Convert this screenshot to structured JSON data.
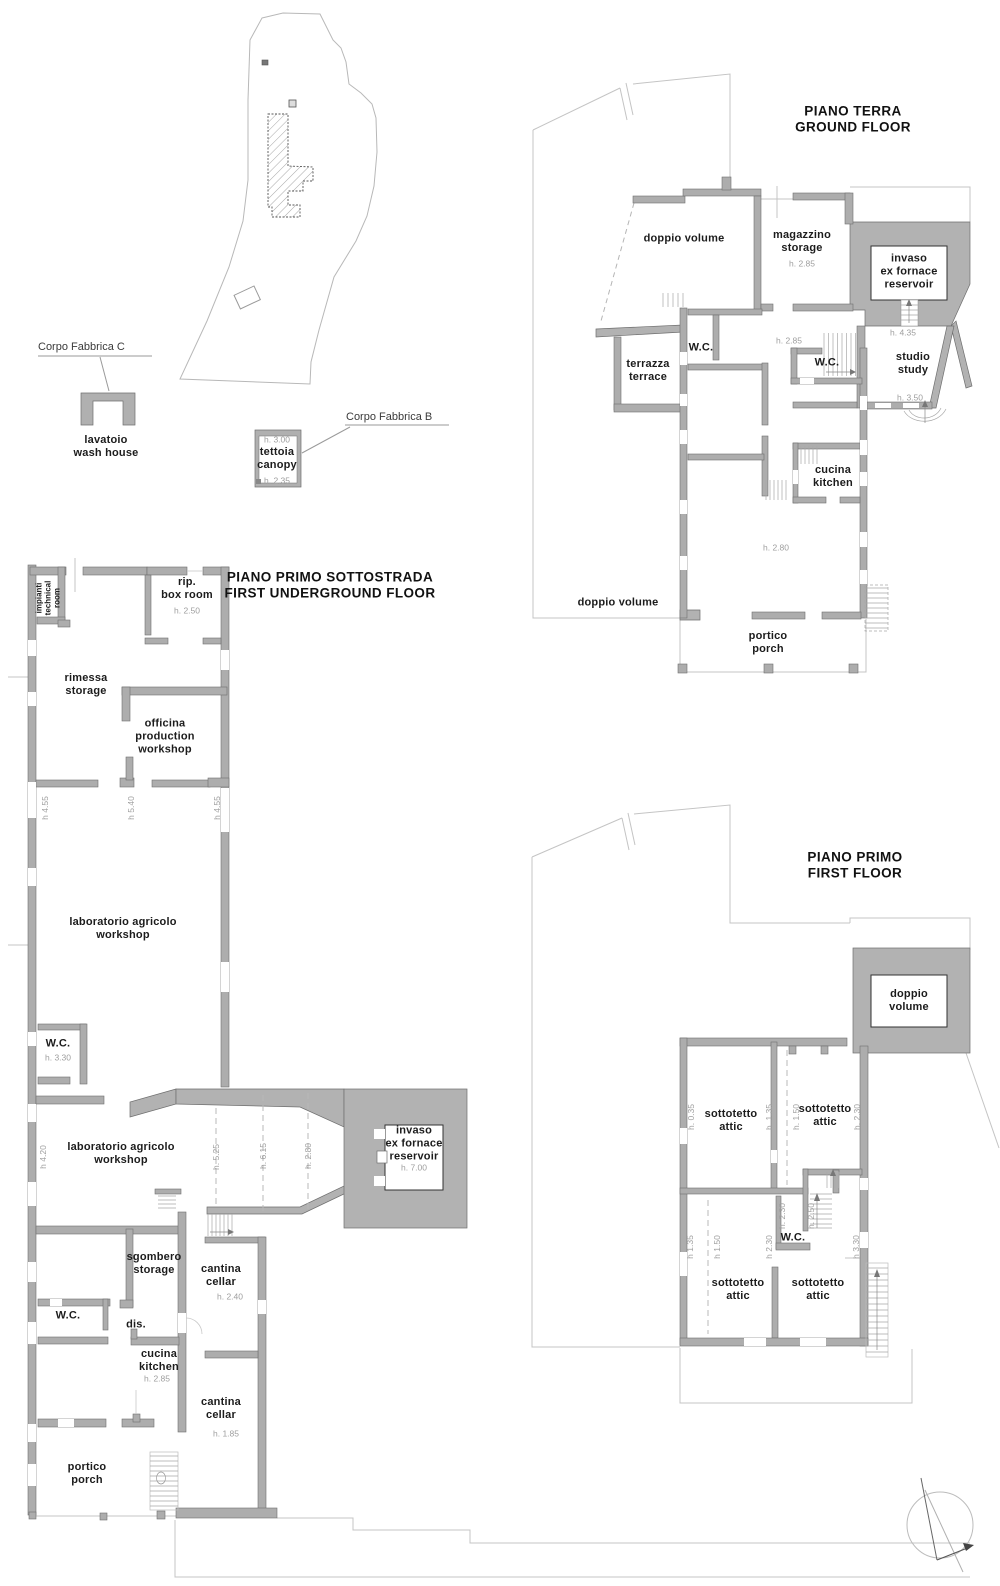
{
  "drawing_type": "architectural floor plans",
  "colors": {
    "wall": "#adadad",
    "poche": "#b2b2b2",
    "thin_line": "#c4c4c4",
    "height_text": "#9e9e9e",
    "label_text": "#1c1c1c"
  },
  "floors": [
    "PIANO TERRA / GROUND FLOOR",
    "PIANO PRIMO SOTTOSTRADA / FIRST UNDERGROUND FLOOR",
    "PIANO PRIMO / FIRST FLOOR"
  ],
  "labels": [
    {
      "n": "site-corpo-fabbrica-c-label",
      "c": "note",
      "x": 38,
      "y": 347,
      "t": "Corpo Fabbrica C"
    },
    {
      "n": "site-corpo-fabbrica-b-label",
      "c": "note",
      "x": 346,
      "y": 417,
      "t": "Corpo Fabbrica B"
    },
    {
      "n": "site-lavatoio-label",
      "c": "room",
      "x": 106,
      "y": 447,
      "t": "lavatoio\nwash house"
    },
    {
      "n": "site-tettoia-height-top",
      "c": "h",
      "x": 277,
      "y": 440,
      "t": "h. 3.00"
    },
    {
      "n": "site-tettoia-label",
      "c": "room",
      "x": 277,
      "y": 459,
      "t": "tettoia\ncanopy"
    },
    {
      "n": "site-tettoia-height-bottom",
      "c": "h",
      "x": 277,
      "y": 481,
      "t": "h. 2.35"
    },
    {
      "n": "gf-title",
      "c": "title",
      "x": 853,
      "y": 119,
      "t": "PIANO TERRA\nGROUND FLOOR"
    },
    {
      "n": "gf-doppio-volume-top",
      "c": "room",
      "x": 684,
      "y": 239,
      "t": "doppio volume"
    },
    {
      "n": "gf-magazzino",
      "c": "room",
      "x": 802,
      "y": 242,
      "t": "magazzino\nstorage"
    },
    {
      "n": "gf-magazzino-height",
      "c": "h",
      "x": 802,
      "y": 264,
      "t": "h. 2.85"
    },
    {
      "n": "gf-invaso",
      "c": "room",
      "x": 909,
      "y": 272,
      "t": "invaso\nex fornace\nreservoir"
    },
    {
      "n": "gf-height-435",
      "c": "h",
      "x": 903,
      "y": 333,
      "t": "h. 4.35"
    },
    {
      "n": "gf-wc-1",
      "c": "room",
      "x": 701,
      "y": 348,
      "t": "W.C."
    },
    {
      "n": "gf-height-285-hall",
      "c": "h",
      "x": 789,
      "y": 341,
      "t": "h. 2.85"
    },
    {
      "n": "gf-terrazza",
      "c": "room",
      "x": 648,
      "y": 371,
      "t": "terrazza\nterrace"
    },
    {
      "n": "gf-wc-2",
      "c": "room",
      "x": 827,
      "y": 363,
      "t": "W.C."
    },
    {
      "n": "gf-studio",
      "c": "room",
      "x": 913,
      "y": 364,
      "t": "studio\nstudy"
    },
    {
      "n": "gf-height-350",
      "c": "h",
      "x": 910,
      "y": 398,
      "t": "h. 3.50"
    },
    {
      "n": "gf-cucina",
      "c": "room",
      "x": 833,
      "y": 477,
      "t": "cucina\nkitchen"
    },
    {
      "n": "gf-height-280",
      "c": "h",
      "x": 776,
      "y": 548,
      "t": "h. 2.80"
    },
    {
      "n": "gf-doppio-volume-bottom",
      "c": "room",
      "x": 618,
      "y": 603,
      "t": "doppio volume"
    },
    {
      "n": "gf-portico",
      "c": "room",
      "x": 768,
      "y": 643,
      "t": "portico\nporch"
    },
    {
      "n": "ug-title",
      "c": "title",
      "x": 330,
      "y": 585,
      "t": "PIANO PRIMO SOTTOSTRADA\nFIRST UNDERGROUND FLOOR"
    },
    {
      "n": "ug-impianti",
      "c": "vroom",
      "x": 48,
      "y": 598,
      "t": "impianti\ntechnical\nroom"
    },
    {
      "n": "ug-rip-box-room",
      "c": "room",
      "x": 187,
      "y": 589,
      "t": "rip.\nbox room"
    },
    {
      "n": "ug-rip-height",
      "c": "h",
      "x": 187,
      "y": 611,
      "t": "h. 2.50"
    },
    {
      "n": "ug-rimessa",
      "c": "room",
      "x": 86,
      "y": 685,
      "t": "rimessa\nstorage"
    },
    {
      "n": "ug-officina",
      "c": "room",
      "x": 165,
      "y": 737,
      "t": "officina\nproduction\nworkshop"
    },
    {
      "n": "ug-height-455-left",
      "c": "vh",
      "x": 45,
      "y": 808,
      "t": "h 4.55"
    },
    {
      "n": "ug-height-540",
      "c": "vh",
      "x": 131,
      "y": 808,
      "t": "h 5.40"
    },
    {
      "n": "ug-height-455-right",
      "c": "vh",
      "x": 217,
      "y": 808,
      "t": "h 4.55"
    },
    {
      "n": "ug-laboratorio-1",
      "c": "room",
      "x": 123,
      "y": 929,
      "t": "laboratorio agricolo\nworkshop"
    },
    {
      "n": "ug-wc-1",
      "c": "room",
      "x": 58,
      "y": 1044,
      "t": "W.C."
    },
    {
      "n": "ug-wc-1-height",
      "c": "h",
      "x": 58,
      "y": 1058,
      "t": "h. 3.30"
    },
    {
      "n": "ug-laboratorio-2",
      "c": "room",
      "x": 121,
      "y": 1154,
      "t": "laboratorio agricolo\nworkshop"
    },
    {
      "n": "ug-height-420",
      "c": "vh",
      "x": 43,
      "y": 1157,
      "t": "h 4.20"
    },
    {
      "n": "ug-height-525",
      "c": "vh",
      "x": 216,
      "y": 1157,
      "t": "h. 5.25"
    },
    {
      "n": "ug-height-615",
      "c": "vh",
      "x": 263,
      "y": 1156,
      "t": "h. 6.15"
    },
    {
      "n": "ug-height-280",
      "c": "vh",
      "x": 308,
      "y": 1156,
      "t": "h. 2.80"
    },
    {
      "n": "ug-invaso",
      "c": "room",
      "x": 414,
      "y": 1144,
      "t": "invaso\nex fornace\nreservoir"
    },
    {
      "n": "ug-invaso-height",
      "c": "h",
      "x": 414,
      "y": 1168,
      "t": "h. 7.00"
    },
    {
      "n": "ug-sgombero",
      "c": "room",
      "x": 154,
      "y": 1264,
      "t": "sgombero\nstorage"
    },
    {
      "n": "ug-cantina-1",
      "c": "room",
      "x": 221,
      "y": 1276,
      "t": "cantina\ncellar"
    },
    {
      "n": "ug-cantina-1-height",
      "c": "h",
      "x": 230,
      "y": 1297,
      "t": "h. 2.40"
    },
    {
      "n": "ug-wc-2",
      "c": "room",
      "x": 68,
      "y": 1316,
      "t": "W.C."
    },
    {
      "n": "ug-dis",
      "c": "room",
      "x": 136,
      "y": 1325,
      "t": "dis."
    },
    {
      "n": "ug-cucina",
      "c": "room",
      "x": 159,
      "y": 1361,
      "t": "cucina\nkitchen"
    },
    {
      "n": "ug-cucina-height",
      "c": "h",
      "x": 157,
      "y": 1379,
      "t": "h. 2.85"
    },
    {
      "n": "ug-cantina-2",
      "c": "room",
      "x": 221,
      "y": 1409,
      "t": "cantina\ncellar"
    },
    {
      "n": "ug-cantina-2-height",
      "c": "h",
      "x": 226,
      "y": 1434,
      "t": "h. 1.85"
    },
    {
      "n": "ug-portico",
      "c": "room",
      "x": 87,
      "y": 1474,
      "t": "portico\nporch"
    },
    {
      "n": "ff-title",
      "c": "title",
      "x": 855,
      "y": 865,
      "t": "PIANO PRIMO\nFIRST FLOOR"
    },
    {
      "n": "ff-doppio-volume",
      "c": "room",
      "x": 909,
      "y": 1001,
      "t": "doppio\nvolume"
    },
    {
      "n": "ff-sottotetto-1",
      "c": "room",
      "x": 731,
      "y": 1121,
      "t": "sottotetto\nattic"
    },
    {
      "n": "ff-sottotetto-2",
      "c": "room",
      "x": 825,
      "y": 1116,
      "t": "sottotetto\nattic"
    },
    {
      "n": "ff-height-035",
      "c": "vh",
      "x": 691,
      "y": 1117,
      "t": "h. 0.35"
    },
    {
      "n": "ff-height-135-a",
      "c": "vh",
      "x": 769,
      "y": 1117,
      "t": "h. 1.35"
    },
    {
      "n": "ff-height-150-a",
      "c": "vh",
      "x": 796,
      "y": 1117,
      "t": "h. 1.50"
    },
    {
      "n": "ff-height-230-a",
      "c": "vh",
      "x": 857,
      "y": 1117,
      "t": "h. 2.30"
    },
    {
      "n": "ff-height-230-b",
      "c": "vh",
      "x": 782,
      "y": 1216,
      "t": "h. 2.30"
    },
    {
      "n": "ff-height-250",
      "c": "vh",
      "x": 811,
      "y": 1216,
      "t": "h. 2.50"
    },
    {
      "n": "ff-wc",
      "c": "room",
      "x": 793,
      "y": 1238,
      "t": "W.C."
    },
    {
      "n": "ff-height-135-b",
      "c": "vh",
      "x": 690,
      "y": 1247,
      "t": "h 1.35"
    },
    {
      "n": "ff-height-150-b",
      "c": "vh",
      "x": 717,
      "y": 1247,
      "t": "h 1.50"
    },
    {
      "n": "ff-height-230-c",
      "c": "vh",
      "x": 769,
      "y": 1247,
      "t": "h 2.30"
    },
    {
      "n": "ff-height-330",
      "c": "vh",
      "x": 856,
      "y": 1247,
      "t": "h 3.30"
    },
    {
      "n": "ff-sottotetto-3",
      "c": "room",
      "x": 738,
      "y": 1290,
      "t": "sottotetto\nattic"
    },
    {
      "n": "ff-sottotetto-4",
      "c": "room",
      "x": 818,
      "y": 1290,
      "t": "sottotetto\nattic"
    }
  ]
}
